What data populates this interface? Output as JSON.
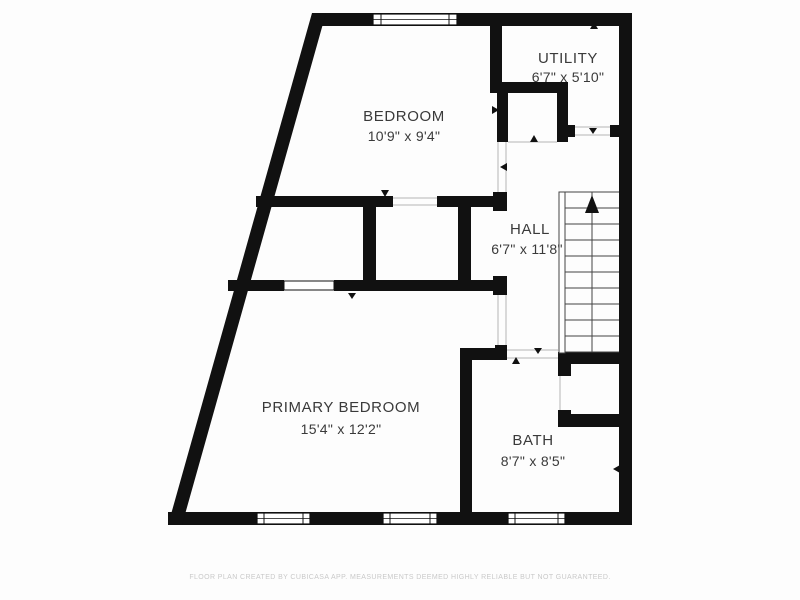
{
  "canvas": {
    "background": "#fdfdfd",
    "wall_color": "#111111",
    "label_color": "#3a3a3a",
    "footer_color": "#c9c9c9"
  },
  "rooms": [
    {
      "name": "BEDROOM",
      "dimensions": "10'9\" x 9'4\""
    },
    {
      "name": "UTILITY",
      "dimensions": "6'7\" x 5'10\""
    },
    {
      "name": "HALL",
      "dimensions": "6'7\" x 11'8\""
    },
    {
      "name": "PRIMARY BEDROOM",
      "dimensions": "15'4\" x 12'2\""
    },
    {
      "name": "BATH",
      "dimensions": "8'7\" x 8'5\""
    }
  ],
  "stairs": {
    "direction": "up"
  },
  "footer": {
    "disclaimer": "FLOOR PLAN CREATED BY CUBICASA APP. MEASUREMENTS DEEMED HIGHLY RELIABLE BUT NOT GUARANTEED."
  }
}
